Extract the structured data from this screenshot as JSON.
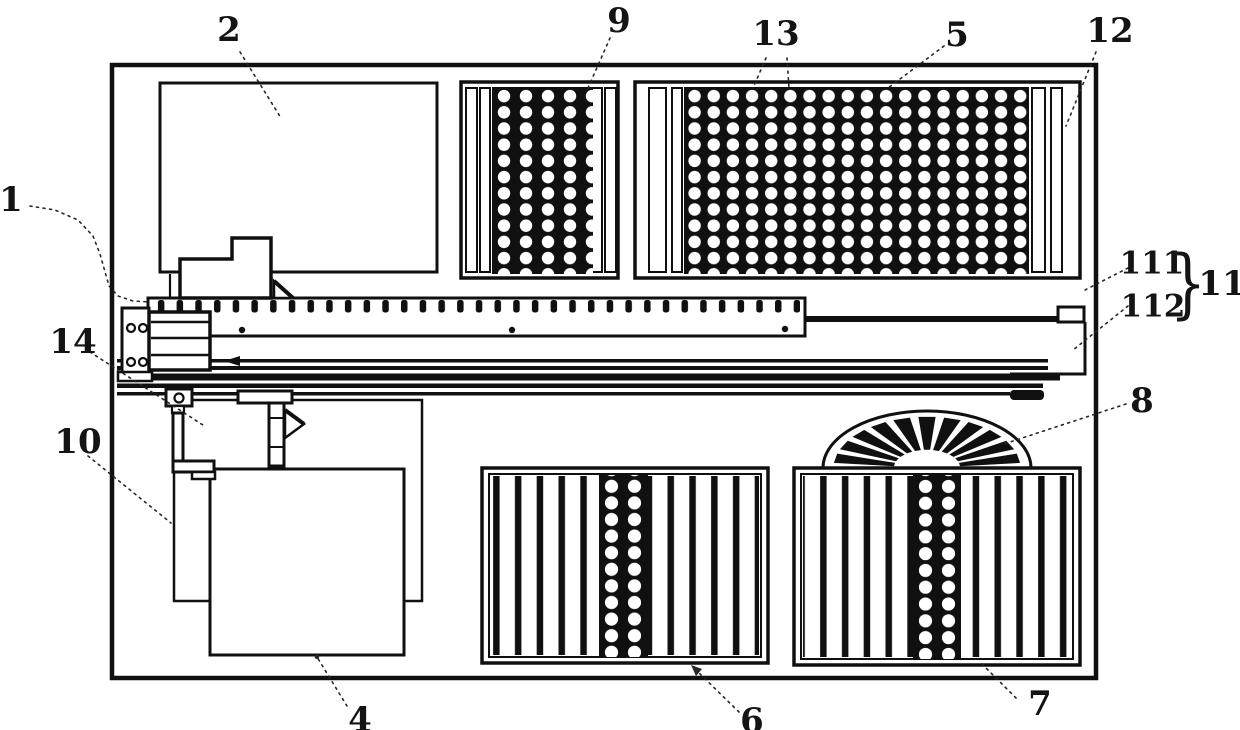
{
  "figure": {
    "kind": "patent-machine-top-view-diagram",
    "callouts": [
      {
        "label": "1",
        "cx": 11,
        "cy": 200,
        "size": 34,
        "leader": [
          [
            30,
            206
          ],
          [
            55,
            210
          ],
          [
            78,
            220
          ],
          [
            93,
            236
          ],
          [
            100,
            254
          ],
          [
            109,
            286
          ],
          [
            118,
            296
          ],
          [
            133,
            301
          ],
          [
            150,
            302
          ]
        ]
      },
      {
        "label": "2",
        "cx": 229,
        "cy": 30,
        "size": 34,
        "leader": [
          [
            240,
            52
          ],
          [
            281,
            118
          ]
        ]
      },
      {
        "label": "9",
        "cx": 619,
        "cy": 21,
        "size": 34,
        "leader": [
          [
            610,
            38
          ],
          [
            588,
            88
          ]
        ]
      },
      {
        "label": "13",
        "cx": 776,
        "cy": 34,
        "size": 34,
        "leader": [
          [
            766,
            58
          ],
          [
            753,
            88
          ]
        ],
        "leader2": [
          [
            787,
            58
          ],
          [
            789,
            88
          ]
        ]
      },
      {
        "label": "5",
        "cx": 957,
        "cy": 35,
        "size": 34,
        "leader": [
          [
            944,
            46
          ],
          [
            888,
            88
          ]
        ]
      },
      {
        "label": "12",
        "cx": 1110,
        "cy": 31,
        "size": 34,
        "leader": [
          [
            1096,
            52
          ],
          [
            1066,
            126
          ]
        ]
      },
      {
        "label": "111",
        "cx": 1152,
        "cy": 264,
        "size": 31,
        "leader": [
          [
            1128,
            268
          ],
          [
            1083,
            291
          ]
        ]
      },
      {
        "label": "112",
        "cx": 1153,
        "cy": 307,
        "size": 31,
        "leader": [
          [
            1128,
            306
          ],
          [
            1073,
            350
          ]
        ]
      },
      {
        "label": "11",
        "cx": 1222,
        "cy": 284,
        "size": 34
      },
      {
        "label": "8",
        "cx": 1142,
        "cy": 401,
        "size": 34,
        "leader": [
          [
            1126,
            404
          ],
          [
            1004,
            444
          ]
        ]
      },
      {
        "label": "14",
        "cx": 73,
        "cy": 342,
        "size": 34,
        "leader": [
          [
            90,
            352
          ],
          [
            206,
            427
          ]
        ]
      },
      {
        "label": "10",
        "cx": 78,
        "cy": 442,
        "size": 34,
        "leader": [
          [
            88,
            456
          ],
          [
            171,
            523
          ]
        ]
      },
      {
        "label": "4",
        "cx": 360,
        "cy": 720,
        "size": 34,
        "leader": [
          [
            347,
            706
          ],
          [
            317,
            657
          ]
        ],
        "dot": [
          317,
          657
        ]
      },
      {
        "label": "6",
        "cx": 752,
        "cy": 721,
        "size": 34,
        "leader": [
          [
            739,
            712
          ],
          [
            696,
            670
          ]
        ],
        "arrow": [
          [
            691,
            665
          ],
          [
            702,
            669
          ],
          [
            696,
            676
          ]
        ]
      },
      {
        "label": "7",
        "cx": 1040,
        "cy": 704,
        "size": 34,
        "leader": [
          [
            1016,
            698
          ],
          [
            1002,
            684
          ],
          [
            988,
            670
          ],
          [
            980,
            662
          ]
        ]
      }
    ],
    "brace": {
      "glyph": "}",
      "cx": 1188,
      "cy": 283,
      "size": 76
    }
  }
}
